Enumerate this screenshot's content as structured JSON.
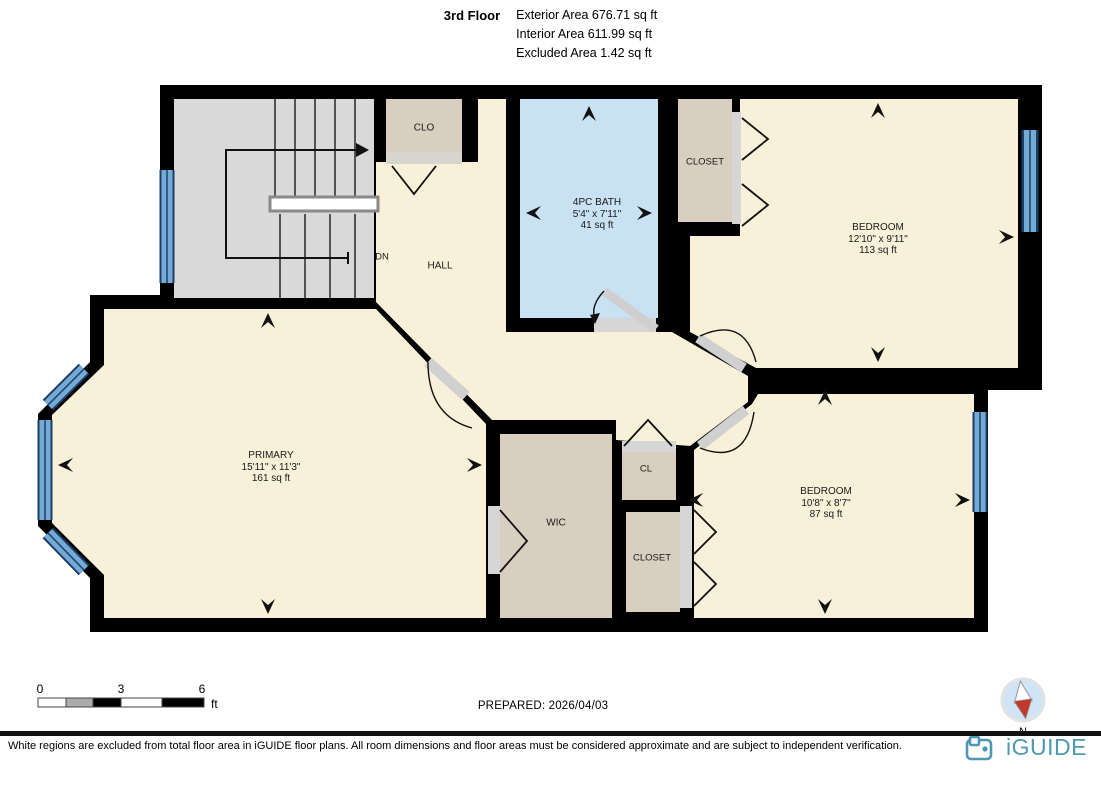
{
  "header": {
    "floor": "3rd Floor",
    "areas": {
      "exterior": "Exterior Area 676.71 sq ft",
      "interior": "Interior Area 611.99 sq ft",
      "excluded": "Excluded Area 1.42 sq ft"
    }
  },
  "rooms": {
    "clo": {
      "name": "CLO"
    },
    "dn": {
      "name": "DN"
    },
    "hall": {
      "name": "HALL"
    },
    "bath": {
      "name": "4PC BATH",
      "dims": "5'4\" x 7'11\"",
      "area": "41 sq ft"
    },
    "closet_top": {
      "name": "CLOSET"
    },
    "bedroom1": {
      "name": "BEDROOM",
      "dims": "12'10\" x 9'11\"",
      "area": "113 sq ft"
    },
    "primary": {
      "name": "PRIMARY",
      "dims": "15'11\" x 11'3\"",
      "area": "161 sq ft"
    },
    "wic": {
      "name": "WIC"
    },
    "cl": {
      "name": "CL"
    },
    "closet_bottom": {
      "name": "CLOSET"
    },
    "bedroom2": {
      "name": "BEDROOM",
      "dims": "10'8\" x 8'7\"",
      "area": "87 sq ft"
    }
  },
  "scale": {
    "t0": "0",
    "t3": "3",
    "t6": "6",
    "unit": "ft"
  },
  "compass": {
    "label": "N"
  },
  "footer": {
    "prepared": "PREPARED: 2026/04/03",
    "disclaimer": "White regions are excluded from total floor area in iGUIDE floor plans. All room dimensions and floor areas must be considered approximate and are subject to independent verification.",
    "brand": "iGUIDE"
  },
  "colors": {
    "wall": "#000000",
    "room": "#f8f0d8",
    "closet": "#d9cfc0",
    "stairs": "#d9d9d9",
    "bath": "#c8e1f3",
    "window_light": "#74aad6",
    "window_dark": "#1d3f66",
    "threshold": "#d8d5cf",
    "brand": "#4E98B4",
    "compass_red": "#c0392b"
  }
}
